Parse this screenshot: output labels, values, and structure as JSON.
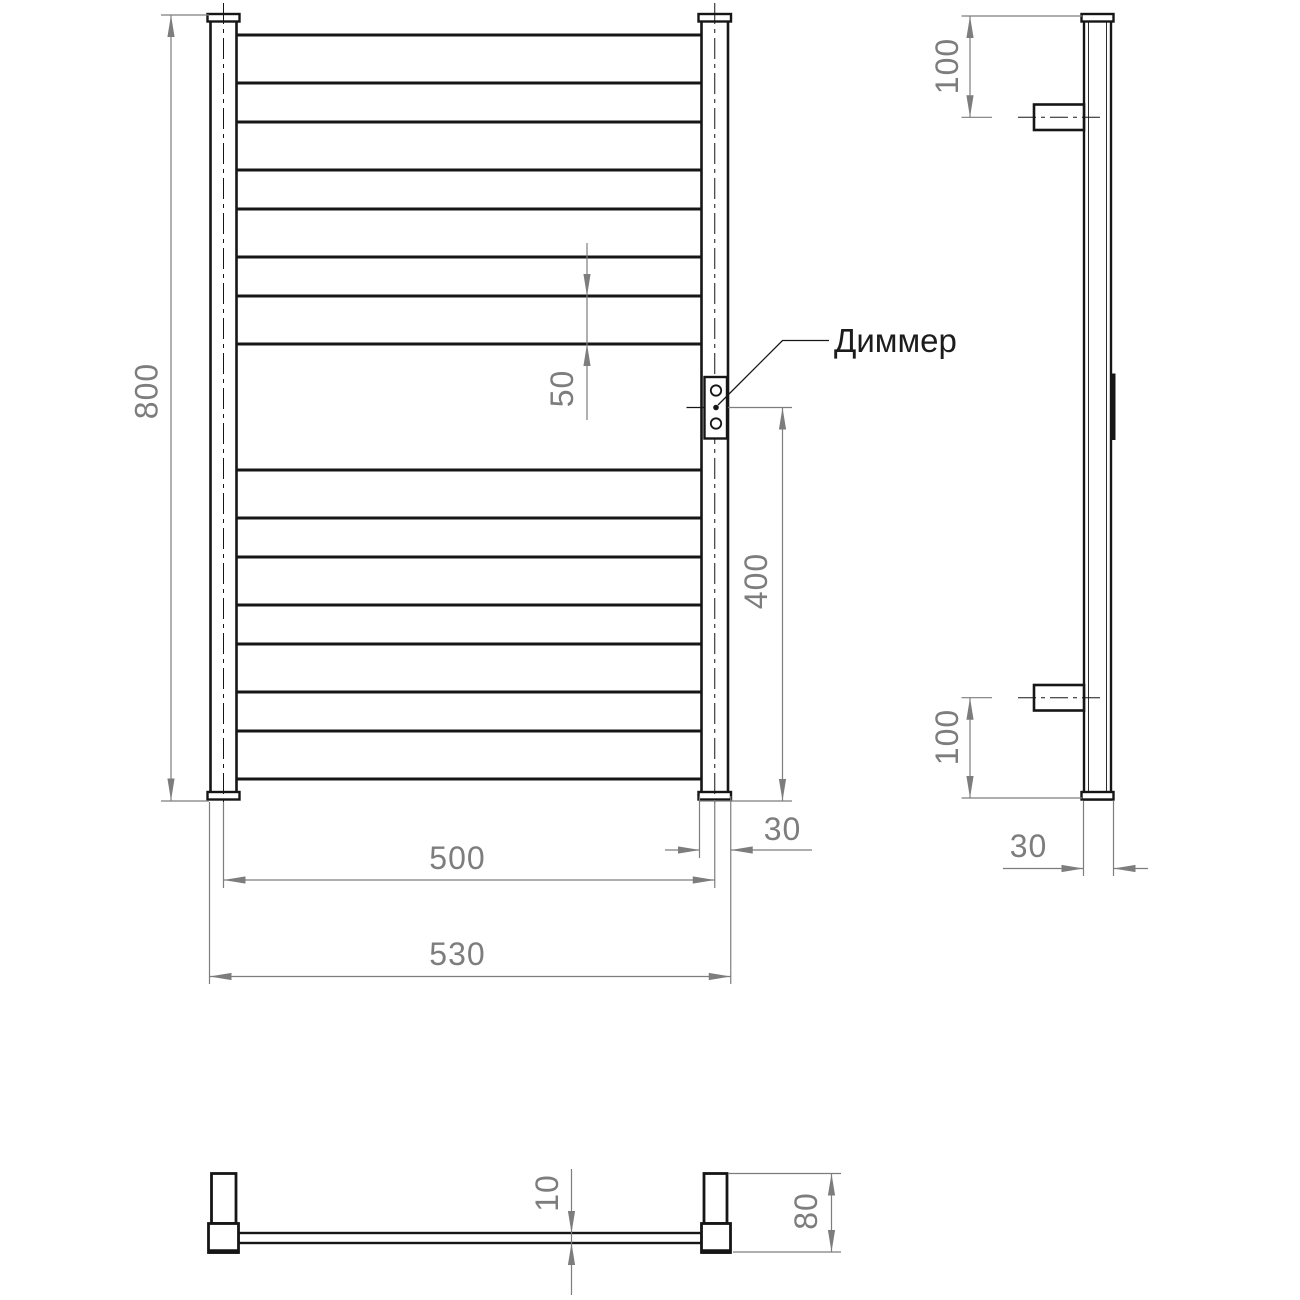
{
  "drawing": {
    "type": "technical-drawing",
    "product": "ladder towel rail, three orthographic views",
    "callout": {
      "dimmer_label": "Диммер"
    },
    "dims": {
      "front_height": "800",
      "rung_profile": "50",
      "dimmer_to_bottom": "400",
      "post_width_front": "30",
      "centers_width": "500",
      "overall_width": "530",
      "side_top_offset": "100",
      "side_bottom_offset": "100",
      "side_depth": "30",
      "rung_thickness": "10",
      "bracket_depth": "80"
    },
    "colors": {
      "object_line": "#161616",
      "dimension_line": "#7d7d7d",
      "background": "#ffffff"
    }
  }
}
